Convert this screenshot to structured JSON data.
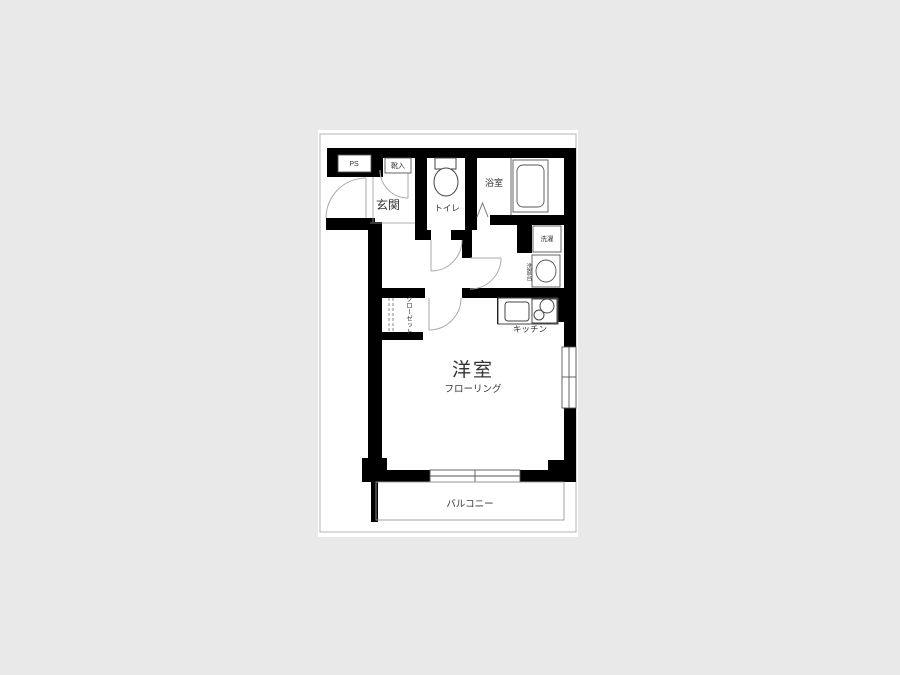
{
  "page": {
    "background_color": "#e9e9e9",
    "canvas_color": "#ffffff",
    "wall_color": "#000000",
    "line_color": "#777777",
    "door_arc_color": "#aaaaaa"
  },
  "floorplan": {
    "labels": {
      "pipe_space": "PS",
      "shoe_box": "靴入",
      "entrance": "玄関",
      "toilet": "トイレ",
      "bathroom": "浴室",
      "laundry": "洗濯",
      "washstand": "洗面台",
      "kitchen": "キッチン",
      "closet": "クローゼット",
      "western_room": "洋室",
      "flooring": "フローリング",
      "balcony": "バルコニー"
    }
  }
}
